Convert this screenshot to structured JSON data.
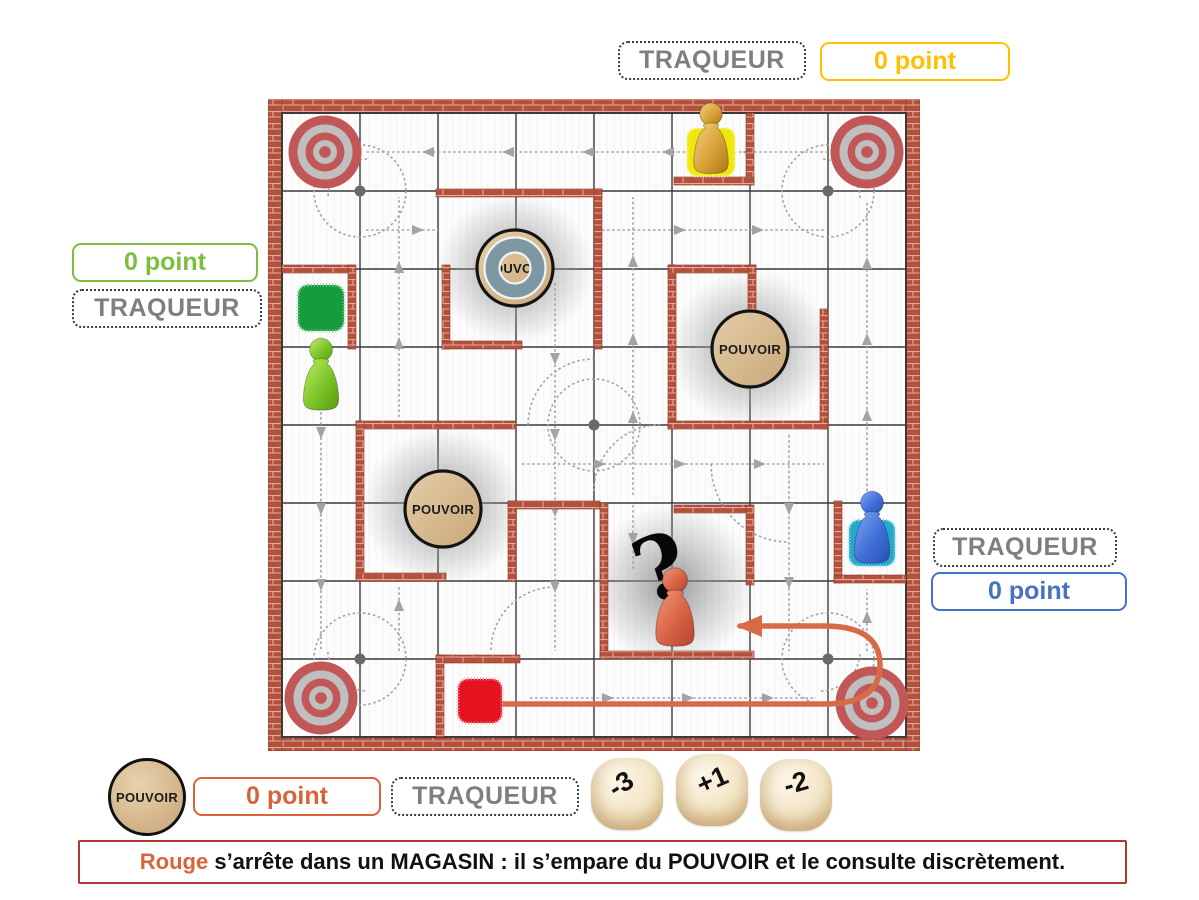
{
  "colors": {
    "yellow": "#FFC000",
    "green": "#7CBF3F",
    "blue": "#4472C4",
    "red": "#D8643C"
  },
  "scoreboard": {
    "yellow": {
      "tracker": "TRAQUEUR",
      "score": "0 point"
    },
    "green": {
      "tracker": "TRAQUEUR",
      "score": "0 point"
    },
    "blue": {
      "tracker": "TRAQUEUR",
      "score": "0 point"
    },
    "red": {
      "tracker": "TRAQUEUR",
      "score": "0 point"
    }
  },
  "board": {
    "power_discs": [
      "POUVOIR",
      "POUVOIR",
      "POUVOIR"
    ],
    "question_mark": "?"
  },
  "power_token": {
    "label": "POUVOIR"
  },
  "dice": [
    {
      "value": "-3"
    },
    {
      "value": "+1"
    },
    {
      "value": "-2"
    }
  ],
  "message": {
    "subject": "Rouge",
    "text": " s’arrête dans un MAGASIN : il s’empare du POUVOIR et le consulte discrètement."
  }
}
